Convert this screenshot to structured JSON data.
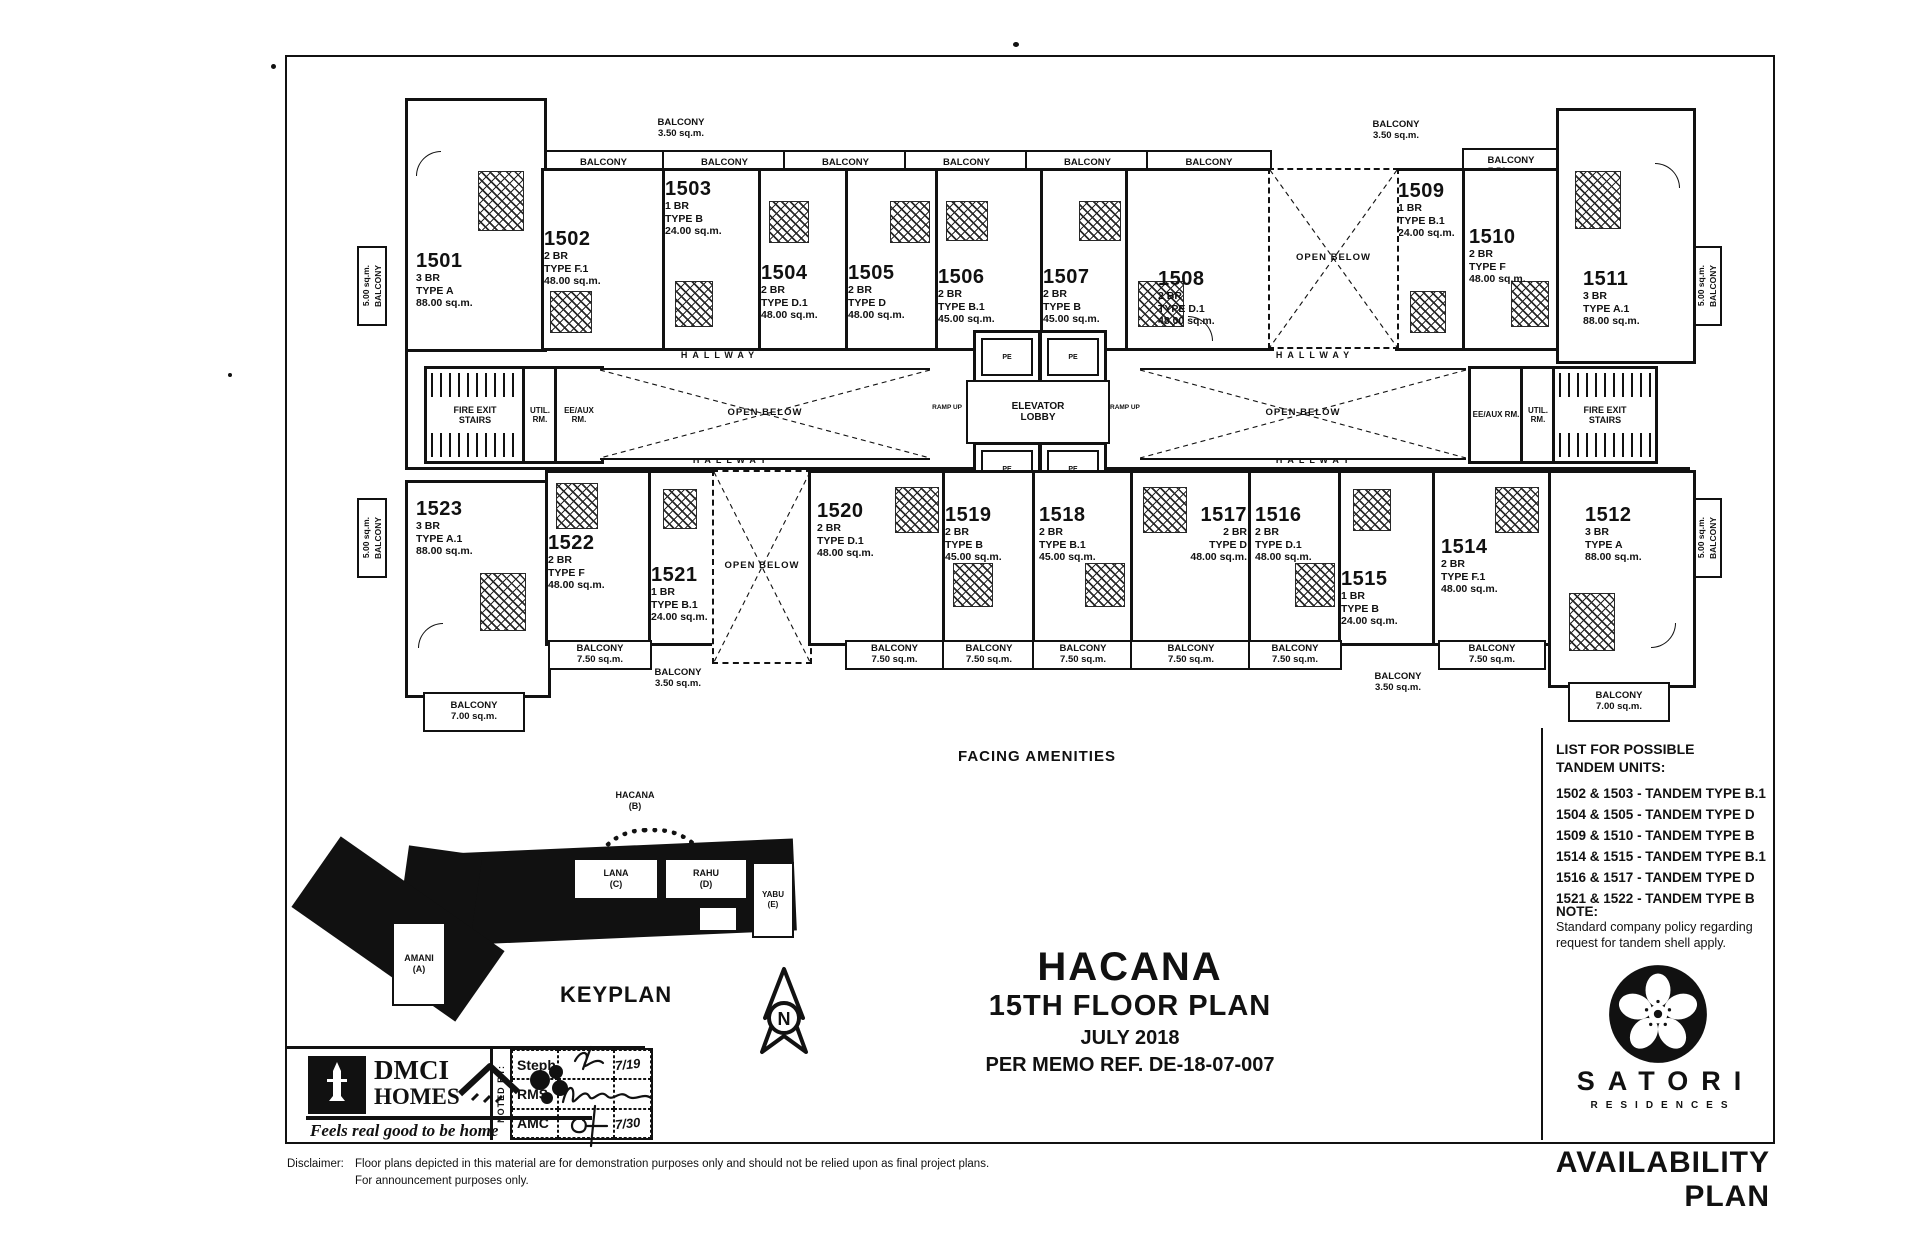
{
  "doc": {
    "availability": "AVAILABILITY PLAN"
  },
  "title": {
    "project": "HACANA",
    "floor": "15TH FLOOR PLAN",
    "date": "JULY 2018",
    "memo": "PER MEMO REF. DE-18-07-007"
  },
  "plan": {
    "facing": "FACING AMENITIES",
    "balcony": "BALCONY",
    "areas": {
      "a35": "3.50 sq.m.",
      "a50": "5.00 sq.m.",
      "a70": "7.00 sq.m.",
      "a75": "7.50 sq.m."
    }
  },
  "core": {
    "hallway": "HALLWAY",
    "open_below": "OPEN BELOW",
    "elevator_1": "ELEVATOR",
    "elevator_2": "LOBBY",
    "fire_exit_1": "FIRE EXIT",
    "fire_exit_2": "STAIRS",
    "util": "UTIL. RM.",
    "eeaux": "EE/AUX RM.",
    "ramp_up": "RAMP UP",
    "pe": "PE"
  },
  "units": [
    {
      "no": "1501",
      "br": "3 BR",
      "type": "TYPE A",
      "area": "88.00 sq.m."
    },
    {
      "no": "1502",
      "br": "2 BR",
      "type": "TYPE F.1",
      "area": "48.00 sq.m."
    },
    {
      "no": "1503",
      "br": "1 BR",
      "type": "TYPE B",
      "area": "24.00 sq.m."
    },
    {
      "no": "1504",
      "br": "2 BR",
      "type": "TYPE D.1",
      "area": "48.00 sq.m."
    },
    {
      "no": "1505",
      "br": "2 BR",
      "type": "TYPE D",
      "area": "48.00 sq.m."
    },
    {
      "no": "1506",
      "br": "2 BR",
      "type": "TYPE B.1",
      "area": "45.00 sq.m."
    },
    {
      "no": "1507",
      "br": "2 BR",
      "type": "TYPE B",
      "area": "45.00 sq.m."
    },
    {
      "no": "1508",
      "br": "2 BR",
      "type": "TYPE D.1",
      "area": "48.00 sq.m."
    },
    {
      "no": "1509",
      "br": "1 BR",
      "type": "TYPE B.1",
      "area": "24.00 sq.m."
    },
    {
      "no": "1510",
      "br": "2 BR",
      "type": "TYPE F",
      "area": "48.00 sq.m."
    },
    {
      "no": "1511",
      "br": "3 BR",
      "type": "TYPE A.1",
      "area": "88.00 sq.m."
    },
    {
      "no": "1512",
      "br": "3 BR",
      "type": "TYPE A",
      "area": "88.00 sq.m."
    },
    {
      "no": "1514",
      "br": "2 BR",
      "type": "TYPE F.1",
      "area": "48.00 sq.m."
    },
    {
      "no": "1515",
      "br": "1 BR",
      "type": "TYPE B",
      "area": "24.00 sq.m."
    },
    {
      "no": "1516",
      "br": "2 BR",
      "type": "TYPE D.1",
      "area": "48.00 sq.m."
    },
    {
      "no": "1517",
      "br": "2 BR",
      "type": "TYPE D",
      "area": "48.00 sq.m."
    },
    {
      "no": "1518",
      "br": "2 BR",
      "type": "TYPE B.1",
      "area": "45.00 sq.m."
    },
    {
      "no": "1519",
      "br": "2 BR",
      "type": "TYPE B",
      "area": "45.00 sq.m."
    },
    {
      "no": "1520",
      "br": "2 BR",
      "type": "TYPE D.1",
      "area": "48.00 sq.m."
    },
    {
      "no": "1521",
      "br": "1 BR",
      "type": "TYPE B.1",
      "area": "24.00 sq.m."
    },
    {
      "no": "1522",
      "br": "2 BR",
      "type": "TYPE F",
      "area": "48.00 sq.m."
    },
    {
      "no": "1523",
      "br": "3 BR",
      "type": "TYPE A.1",
      "area": "88.00 sq.m."
    }
  ],
  "tandem": {
    "heading1": "LIST FOR POSSIBLE",
    "heading2": "TANDEM UNITS:",
    "items": [
      "1502 & 1503 - TANDEM TYPE B.1",
      "1504 & 1505 - TANDEM TYPE D",
      "1509 & 1510 - TANDEM TYPE B",
      "1514 & 1515 - TANDEM TYPE B.1",
      "1516 & 1517 - TANDEM TYPE D",
      "1521 & 1522 - TANDEM TYPE B"
    ]
  },
  "note": {
    "label": "NOTE:",
    "line1": "Standard company policy regarding",
    "line2": "request for tandem shell apply."
  },
  "keyplan": {
    "title": "KEYPLAN",
    "north": "N",
    "hacana_name": "HACANA",
    "hacana_code": "(B)",
    "lana_name": "LANA",
    "lana_code": "(C)",
    "rahu_name": "RAHU",
    "rahu_code": "(D)",
    "yabu_name": "YABU",
    "yabu_code": "(E)",
    "amani_name": "AMANI",
    "amani_code": "(A)"
  },
  "brand": {
    "dmci_1": "DMCI",
    "dmci_2": "HOMES",
    "tagline": "Feels real good to be home",
    "satori": "SATORI",
    "residences": "RESIDENCES"
  },
  "noted_by": {
    "label": "NOTED BY:",
    "rows": [
      {
        "name": "Steph",
        "date": "7/19"
      },
      {
        "name": "RMS",
        "date": ""
      },
      {
        "name": "AMC",
        "date": "7/30"
      }
    ]
  },
  "disclaimer": {
    "label": "Disclaimer:",
    "line1": "Floor plans depicted in this material are for demonstration purposes only and should not be relied upon as final project plans.",
    "line2": "For announcement purposes only."
  }
}
